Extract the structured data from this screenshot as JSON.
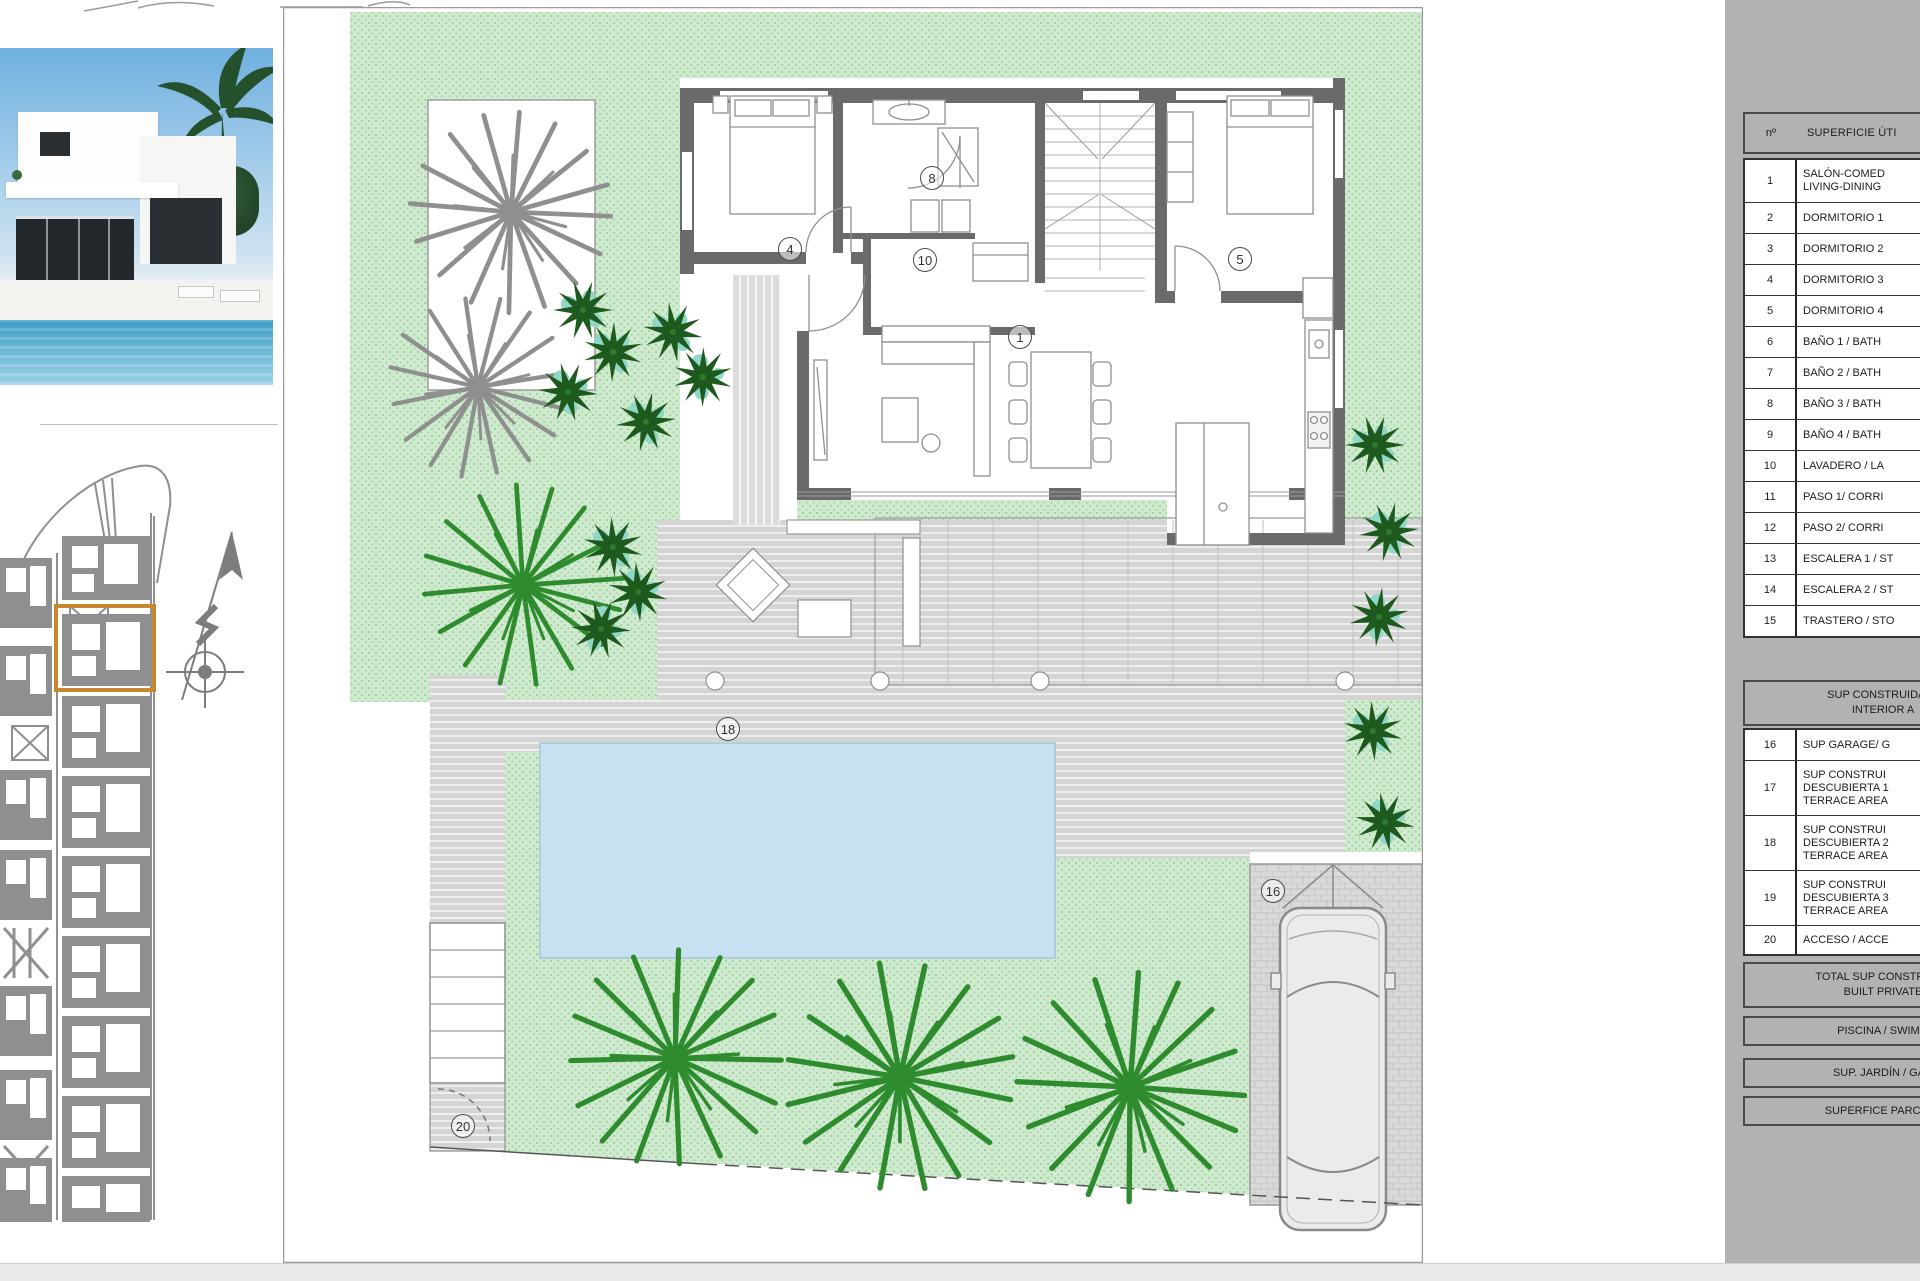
{
  "panel": {
    "header": {
      "col_num": "nº",
      "col_label": "SUPERFICIE ÚTI"
    },
    "rows": [
      {
        "num": "1",
        "l1": "SALÓN-COMED",
        "l2": "LIVING-DINING"
      },
      {
        "num": "2",
        "l1": "DORMITORIO 1"
      },
      {
        "num": "3",
        "l1": "DORMITORIO 2"
      },
      {
        "num": "4",
        "l1": "DORMITORIO 3"
      },
      {
        "num": "5",
        "l1": "DORMITORIO 4"
      },
      {
        "num": "6",
        "l1": "BAÑO 1 / BATH"
      },
      {
        "num": "7",
        "l1": "BAÑO 2 / BATH"
      },
      {
        "num": "8",
        "l1": "BAÑO 3 / BATH"
      },
      {
        "num": "9",
        "l1": "BAÑO 4 / BATH"
      },
      {
        "num": "10",
        "l1": "LAVADERO / LA"
      },
      {
        "num": "11",
        "l1": "PASO 1/ CORRI"
      },
      {
        "num": "12",
        "l1": "PASO 2/ CORRI"
      },
      {
        "num": "13",
        "l1": "ESCALERA 1 / ST"
      },
      {
        "num": "14",
        "l1": "ESCALERA 2 / ST"
      },
      {
        "num": "15",
        "l1": "TRASTERO / STO"
      }
    ],
    "section2": {
      "l1": "SUP CONSTRUIDA IN",
      "l2": "INTERIOR A"
    },
    "rows2": [
      {
        "num": "16",
        "l1": "SUP GARAGE/ G"
      },
      {
        "num": "17",
        "l1": "SUP CONSTRUI",
        "l2": "DESCUBIERTA 1",
        "l3": "TERRACE AREA"
      },
      {
        "num": "18",
        "l1": "SUP CONSTRUI",
        "l2": "DESCUBIERTA 2",
        "l3": "TERRACE AREA"
      },
      {
        "num": "19",
        "l1": "SUP CONSTRUI",
        "l2": "DESCUBIERTA 3",
        "l3": "TERRACE AREA"
      },
      {
        "num": "20",
        "l1": "ACCESO / ACCE"
      }
    ],
    "total": {
      "l1": "TOTAL SUP CONSTRUIDA",
      "l2": "BUILT PRIVATE"
    },
    "footers": [
      {
        "label": "PISCINA / SWIMM"
      },
      {
        "label": "SUP. JARDÍN / GAR"
      },
      {
        "label": "SUPERFICE PARCELA"
      }
    ]
  },
  "plan": {
    "markers": {
      "m1": {
        "label": "1"
      },
      "m4": {
        "label": "4"
      },
      "m5": {
        "label": "5"
      },
      "m8": {
        "label": "8"
      },
      "m10": {
        "label": "10"
      },
      "m16": {
        "label": "16"
      },
      "m18": {
        "label": "18"
      },
      "m20": {
        "label": "20"
      }
    }
  },
  "colors": {
    "accent_orange": "#c8862e",
    "garden_green": "#cfeacf",
    "pool_blue": "#c7e0f2",
    "panel_gray": "#b2b2b2",
    "wall_gray": "#6a6a6a",
    "siteplan_gray": "#8f8f8f"
  }
}
